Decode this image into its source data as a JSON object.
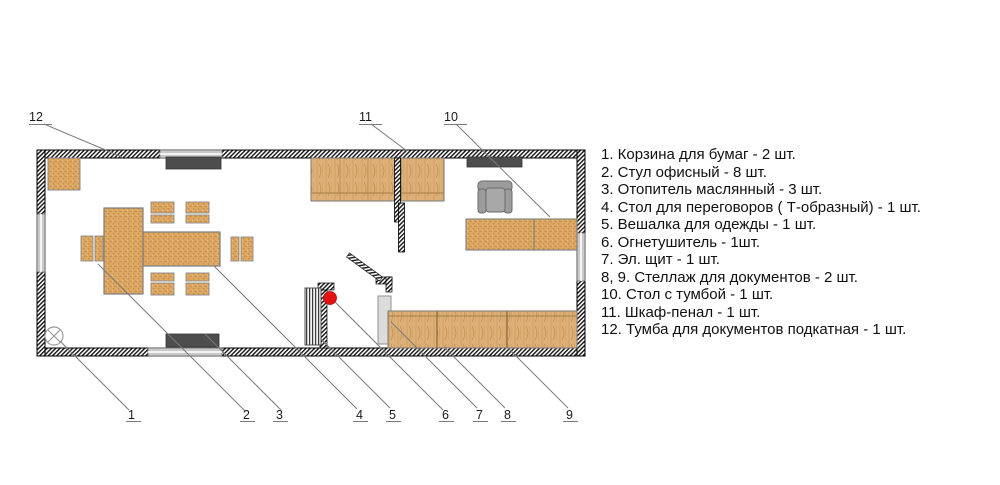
{
  "legend": {
    "lines": [
      "1. Корзина для бумаг - 2 шт.",
      "2. Стул офисный - 8 шт.",
      "3. Отопитель маслянный - 3 шт.",
      "4. Стол для переговоров ( Т-образный) - 1 шт.",
      "5. Вешалка для одежды - 1 шт.",
      "6. Огнетушитель - 1шт.",
      "7. Эл. щит - 1 шт.",
      "8, 9. Стеллаж для документов - 2 шт.",
      "10. Стол с тумбой - 1 шт.",
      "11. Шкаф-пенал - 1 шт.",
      "12. Тумба для документов подкатная - 1 шт."
    ]
  },
  "plan": {
    "callouts": [
      "1",
      "2",
      "3",
      "4",
      "5",
      "6",
      "7",
      "8",
      "9",
      "10",
      "11",
      "12"
    ]
  },
  "colors": {
    "extinguisher_red": "#e31212",
    "heater_gray": "#4d4d4d",
    "window_gray": "#c9c9c9",
    "chair_gray": "#9c9c9c",
    "leader_gray": "#7a7a7a"
  }
}
